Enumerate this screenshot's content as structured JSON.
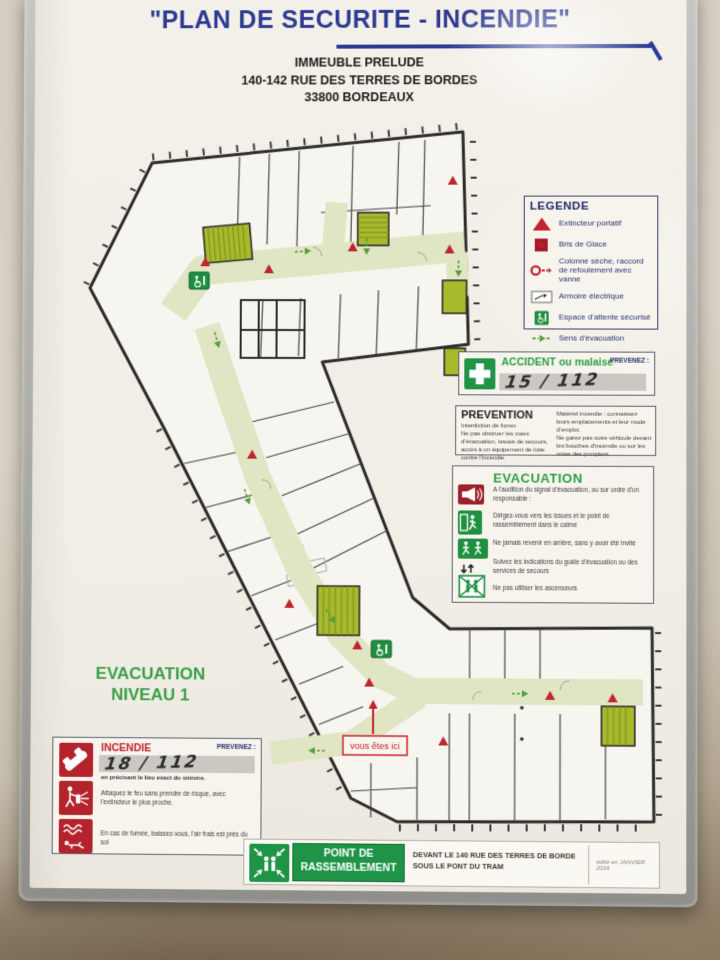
{
  "header": {
    "title": "\"PLAN DE SECURITE - INCENDIE\"",
    "building": "IMMEUBLE PRELUDE",
    "street": "140-142 RUE DES TERRES DE BORDES",
    "city": "33800 BORDEAUX"
  },
  "legend": {
    "title": "LEGENDE",
    "items": [
      {
        "icon": "portable-extinguisher-icon",
        "label": "Extincteur portatif"
      },
      {
        "icon": "break-glass-icon",
        "label": "Bris de Glace"
      },
      {
        "icon": "dry-riser-icon",
        "label": "Colonne sèche, raccord de refoulement avec vanne"
      },
      {
        "icon": "electrical-cabinet-icon",
        "label": "Armoire électrique"
      },
      {
        "icon": "secure-waiting-area-icon",
        "label": "Espace d'attente sécurisé"
      },
      {
        "icon": "evacuation-direction-icon",
        "label": "Sens d'évacuation"
      }
    ]
  },
  "accident_box": {
    "title": "ACCIDENT ou malaise",
    "prevenez_label": "PREVENEZ :",
    "handwritten_number": "15 / 112"
  },
  "prevention_box": {
    "title": "PREVENTION",
    "left_items": [
      "Interdiction de fumer.",
      "Ne pas obstruer les voies d'évacuation, issues de secours, accès à un équipement de lutte contre l'incendie"
    ],
    "right_items": [
      "Matériel incendie : connaissez leurs emplacements et leur mode d'emploi.",
      "Ne garez pas votre véhicule devant les bouches d'incendie ou sur les voies des pompiers."
    ]
  },
  "evacuation_box": {
    "title": "EVACUATION",
    "items": [
      "A l'audition du signal d'évacuation, ou sur ordre d'un responsable :",
      "Dirigez-vous vers les issues et le point de rassemblement dans le calme",
      "Ne jamais revenir en arrière, sans y avoir été invité",
      "Suivez les indications du guide d'évacuation ou des services de secours",
      "Ne pas utiliser les ascenseurs"
    ]
  },
  "level_label": {
    "line1": "EVACUATION",
    "line2": "NIVEAU 1"
  },
  "fire_box": {
    "title": "INCENDIE",
    "prevenez_label": "PREVENEZ :",
    "handwritten_number": "18 / 112",
    "note": "en précisant le lieu exact du sinistre.",
    "instructions": [
      "Attaquez le feu sans prendre de risque, avec l'extincteur le plus proche.",
      "En cas de fumée, baissez-vous, l'air frais est près du sol"
    ]
  },
  "assembly_point": {
    "label_line1": "POINT DE",
    "label_line2": "RASSEMBLEMENT",
    "location_line1": "DEVANT LE 140 RUE DES TERRES DE BORDE",
    "location_line2": "SOUS LE PONT DU TRAM",
    "edition_note": "édité en JANVIER 2016"
  },
  "plan": {
    "you_are_here": "vous êtes ici"
  },
  "colors": {
    "title_blue": "#2c3a93",
    "safety_green": "#1f8f40",
    "safety_red": "#c2242e",
    "stair_olive": "#a6ba2b",
    "corridor_green": "#e0e5c3"
  }
}
